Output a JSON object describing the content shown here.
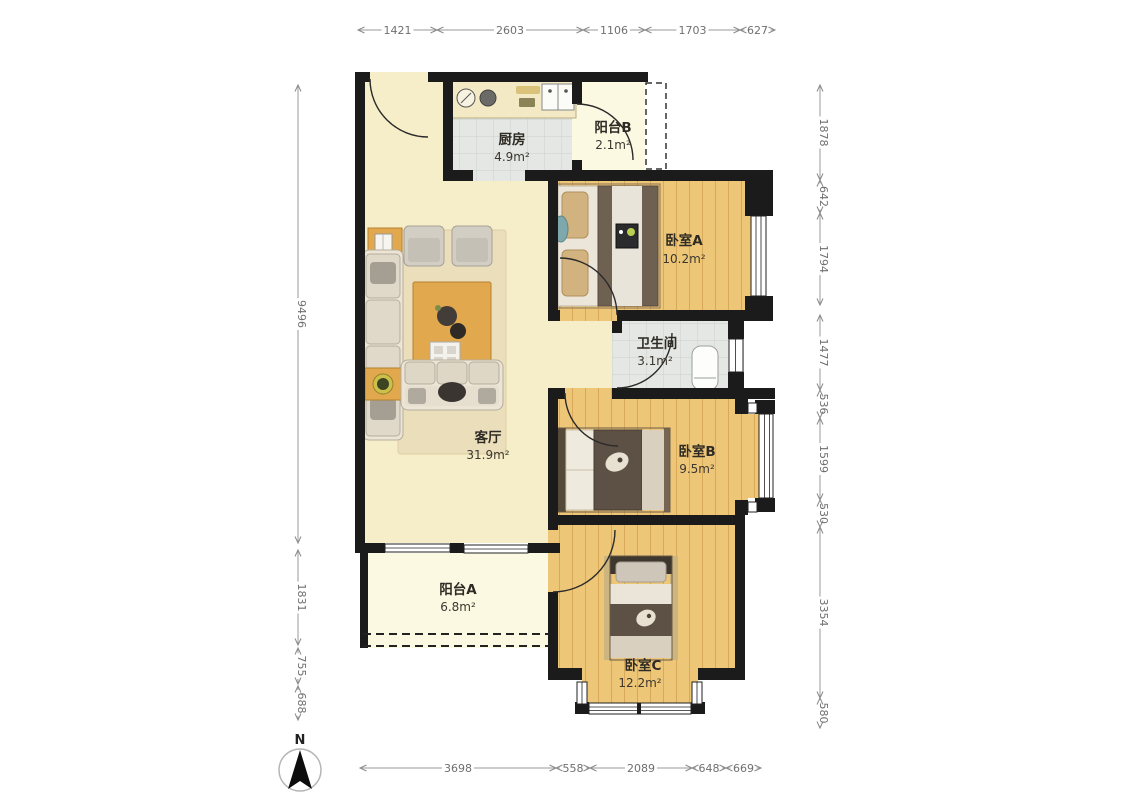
{
  "rooms": {
    "kitchen": {
      "name": "厨房",
      "area": "4.9m²"
    },
    "balcony_b": {
      "name": "阳台B",
      "area": "2.1m²"
    },
    "bedroom_a": {
      "name": "卧室A",
      "area": "10.2m²"
    },
    "bathroom": {
      "name": "卫生间",
      "area": "3.1m²"
    },
    "living_room": {
      "name": "客厅",
      "area": "31.9m²"
    },
    "bedroom_b": {
      "name": "卧室B",
      "area": "9.5m²"
    },
    "balcony_a": {
      "name": "阳台A",
      "area": "6.8m²"
    },
    "bedroom_c": {
      "name": "卧室C",
      "area": "12.2m²"
    }
  },
  "dimensions_mm": {
    "top": [
      "1421",
      "2603",
      "1106",
      "1703",
      "627"
    ],
    "bottom": [
      "3698",
      "558",
      "2089",
      "648",
      "669"
    ],
    "left": [
      "9496",
      "1831",
      "755",
      "688"
    ],
    "right": [
      "1878",
      "642",
      "1794",
      "1477",
      "536",
      "1599",
      "530",
      "3354",
      "580"
    ]
  },
  "compass": {
    "north_label": "N"
  },
  "colors": {
    "wall": "#1b1b1b",
    "wood_floor": "#edc678",
    "living_floor": "#f6eec8",
    "tile_floor": "#e4e7e4",
    "balcony_floor": "#fcf9e3",
    "dimension": "#8a8a8a",
    "table_accent": "#e2a84d"
  }
}
